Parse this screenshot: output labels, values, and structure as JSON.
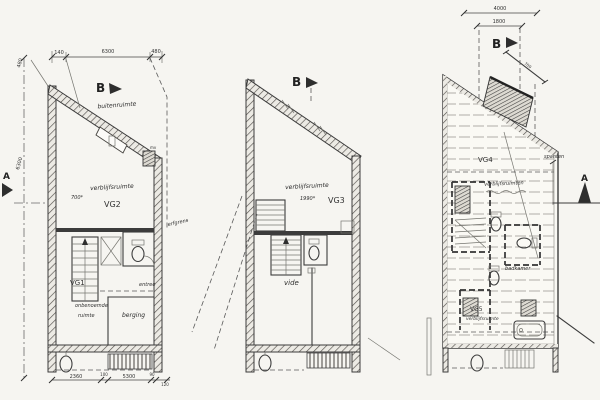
{
  "sheet": {
    "paper_color": "#f6f5f1",
    "ink_color": "#3c3c3c"
  },
  "left_plan": {
    "marker_b": "B",
    "marker_a": "A",
    "buitenruimte_label": "buitenruimte",
    "verblijfsruimte_label": "verblijfsruimte",
    "area_label": "700*",
    "vg2_label": "VG2",
    "vg1_label": "VG1",
    "onbenoemde_label": "onbenoemde",
    "ruimte_label": "ruimte",
    "berging_label": "berging",
    "entree_label": "entree",
    "mv_label": "mv",
    "dims_top": {
      "d1": "140",
      "d2": "6300",
      "d3": "480"
    },
    "dims_left": {
      "d1": "480",
      "d2": "6300"
    },
    "dims_bottom": {
      "d1": "2360",
      "d2": "100",
      "d3": "5300",
      "d4": "90",
      "d5": "120"
    }
  },
  "middle_plan": {
    "marker_b": "B",
    "verblijfsruimte_label": "verblijfsruimte",
    "area_label": "1990*",
    "vg3_label": "VG3",
    "vide_label": "vide",
    "erfgrens_label": "erfgrens"
  },
  "right_plan": {
    "marker_b": "B",
    "marker_a": "A",
    "dims_top": {
      "d1": "4000",
      "d2": "1800"
    },
    "dim_diag": "700",
    "vg4_label": "VG4",
    "verblijfsruimten_label": "verblijfsruimten",
    "badkamer_label": "badkamer",
    "vg5_label": "VG5",
    "verblijfsruimte_label": "verblijfsruimte",
    "spanten_label": "spanten"
  }
}
